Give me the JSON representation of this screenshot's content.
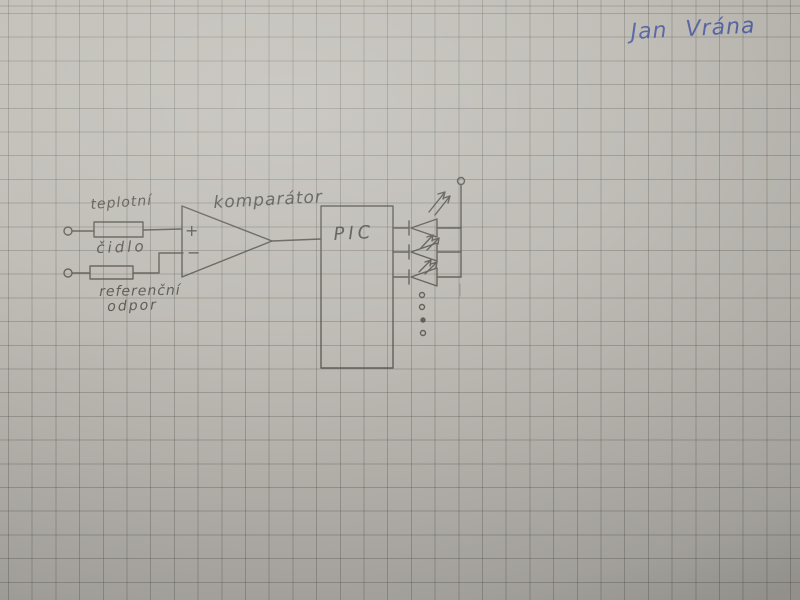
{
  "photo": {
    "description": "Hand-drawn electronic schematic in pencil on squared graph paper",
    "paper_color": "#bcb9b3",
    "grid_color": "#97948c",
    "pencil_color": "#4f4c46",
    "ink_color": "#3d4f9f"
  },
  "signature": {
    "text": "Jan Vrána"
  },
  "schematic": {
    "labels": {
      "sensor_line1": "teplotní",
      "sensor_line2": "čidlo",
      "reference_line1": "referenční",
      "reference_line2": "odpor",
      "comparator": "komparátor",
      "mcu": "PIC",
      "plus": "+",
      "minus": "−"
    },
    "components": [
      {
        "name": "input-terminal-top",
        "kind": "open-terminal"
      },
      {
        "name": "temperature-sensor-resistor",
        "kind": "resistor-box",
        "label": "teplotní čidlo"
      },
      {
        "name": "input-terminal-bottom",
        "kind": "open-terminal"
      },
      {
        "name": "reference-resistor",
        "kind": "resistor-box",
        "label": "referenční odpor"
      },
      {
        "name": "comparator",
        "kind": "opamp-triangle",
        "label": "komparátor",
        "inputs": [
          "+",
          "−"
        ]
      },
      {
        "name": "microcontroller",
        "kind": "box",
        "label": "PIC"
      },
      {
        "name": "led",
        "kind": "led-diode-with-emission-arrows",
        "count": 3
      },
      {
        "name": "continuation-dots",
        "kind": "dots",
        "count": 4
      },
      {
        "name": "supply-terminal",
        "kind": "open-terminal"
      }
    ]
  }
}
